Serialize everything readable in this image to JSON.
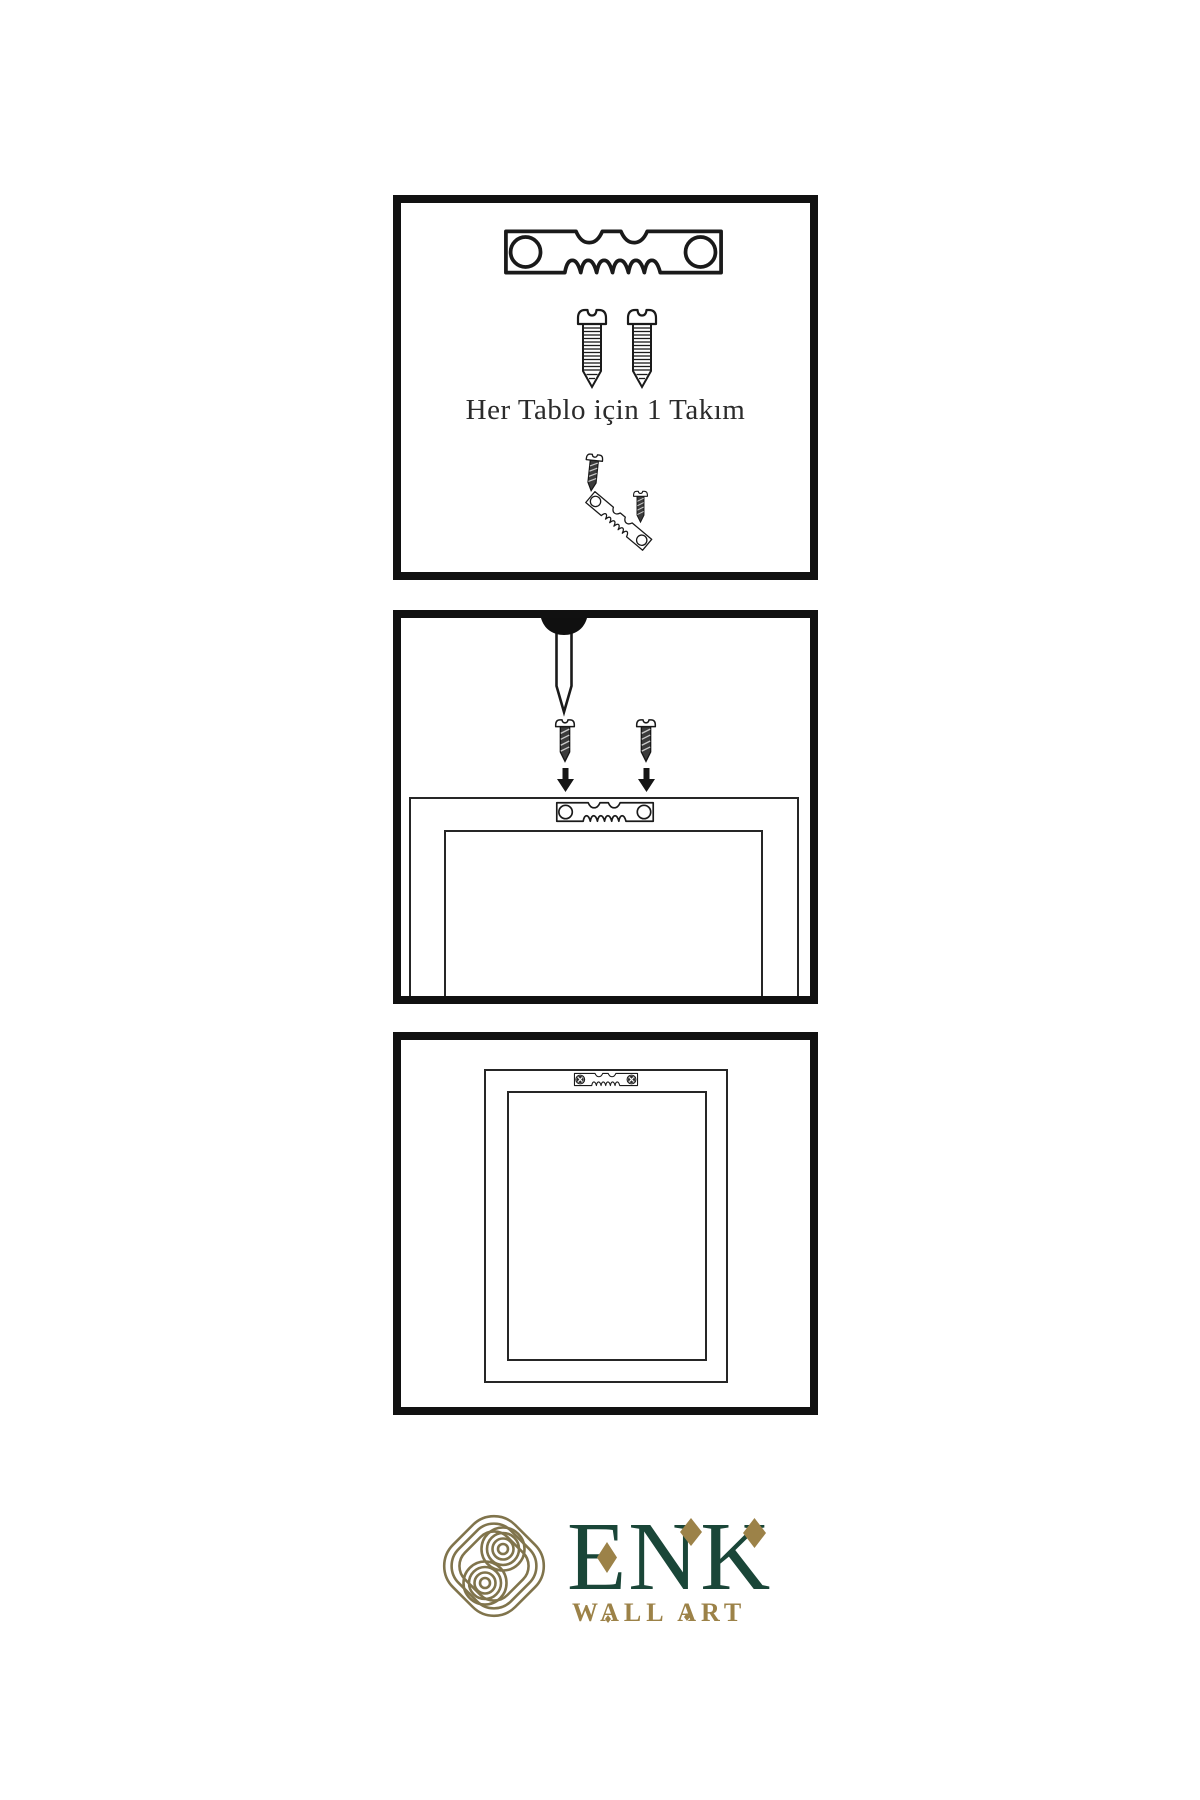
{
  "panels": {
    "kit": {
      "caption": "Her Tablo için 1 Takım",
      "icons": [
        "sawtooth-hanger-icon",
        "screw-icon",
        "screw-icon",
        "dark-screw-icon",
        "angled-sawtooth-hanger-icon",
        "dark-screw-icon"
      ]
    },
    "install": {
      "icons": [
        "nail-icon",
        "dark-screw-icon",
        "dark-screw-icon",
        "arrow-down-icon",
        "arrow-down-icon",
        "frame-back-outline",
        "sawtooth-hanger-icon"
      ]
    },
    "hang": {
      "icons": [
        "picture-frame-outline",
        "sawtooth-hanger-mounted-icon"
      ]
    }
  },
  "logo": {
    "brand": "ENK",
    "tagline": "WALL ART",
    "emblem": "interlocking-knot-icon",
    "colors": {
      "brand_green": "#1A4638",
      "brand_gold": "#9C8248",
      "emblem_gold": "#80744C"
    }
  }
}
